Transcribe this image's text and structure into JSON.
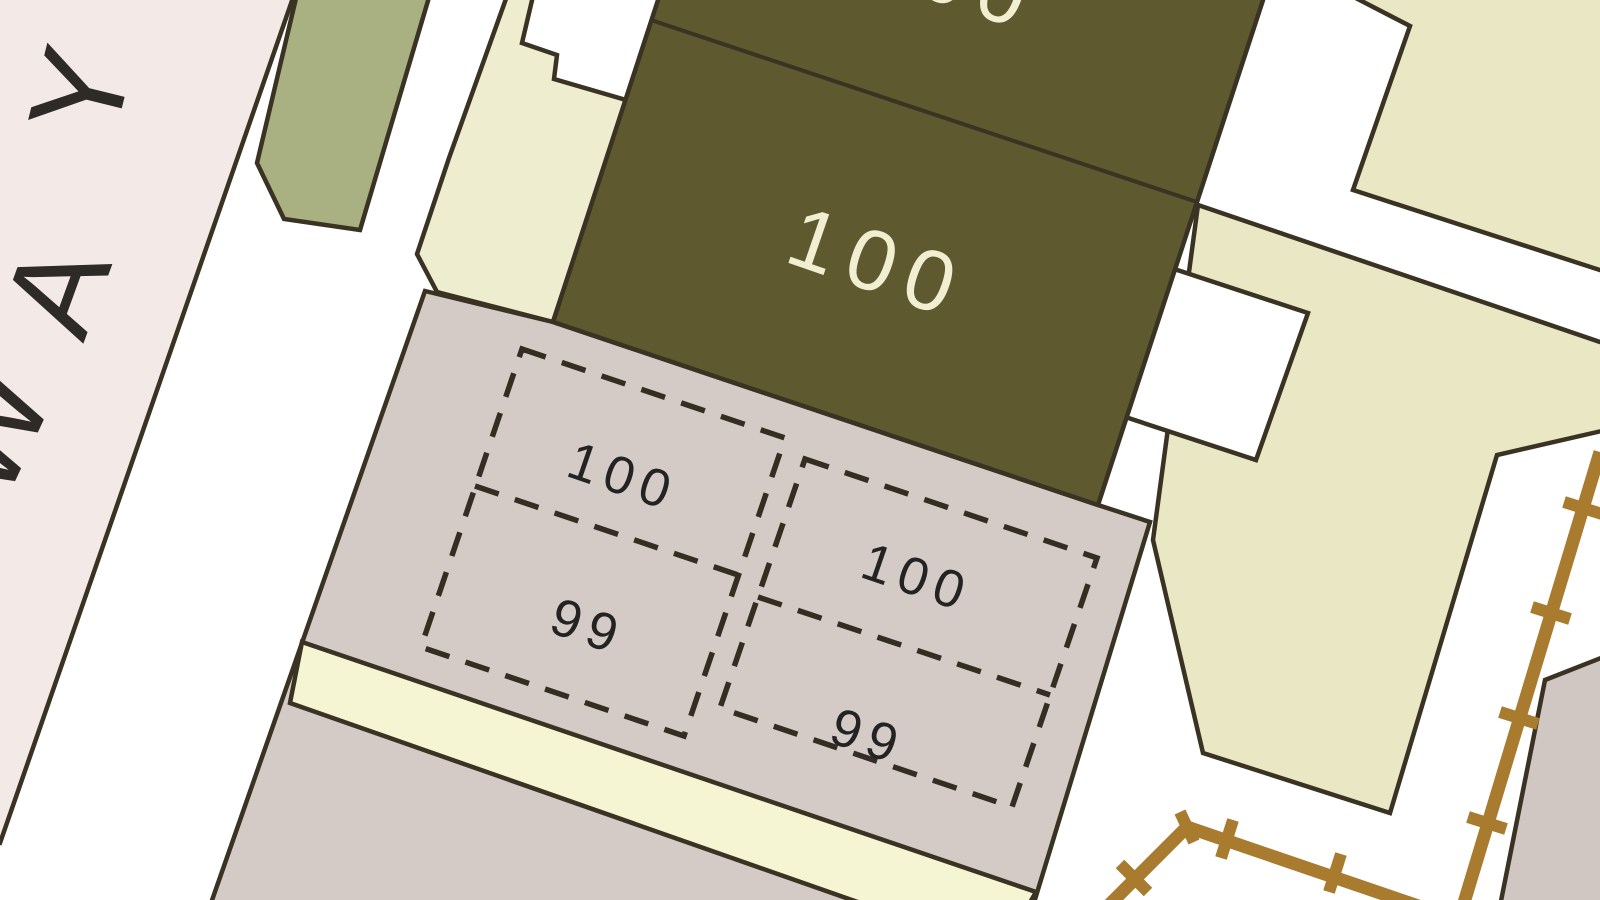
{
  "map": {
    "street": {
      "name": "WAY",
      "chars": [
        "W",
        "A",
        "Y"
      ]
    },
    "main_building": {
      "number": "100",
      "upper_unit_number": "100"
    },
    "plots": [
      {
        "id": "plot-left-upper",
        "number": "100"
      },
      {
        "id": "plot-left-lower",
        "number": "99"
      },
      {
        "id": "plot-right-upper",
        "number": "100"
      },
      {
        "id": "plot-right-lower",
        "number": "99"
      }
    ],
    "colors": {
      "background": "#ffffff",
      "road_pink": "#f3eae7",
      "vegetation_green": "#a9b183",
      "building_olive": "#5e592e",
      "garden_cream": "#efedd0",
      "parcel_beige": "#e9e7c4",
      "parcel_taupe": "#d5cbc6",
      "strip_yellow": "#f5f4d3",
      "corner_gray": "#d1c7c2",
      "outbuilding_white": "#ffffff",
      "fence_brown": "#a87b2e",
      "outline_dark": "#3a3323",
      "building_label": "#f2eed2",
      "plot_label": "#232323",
      "street_label": "#2d2a28"
    }
  }
}
